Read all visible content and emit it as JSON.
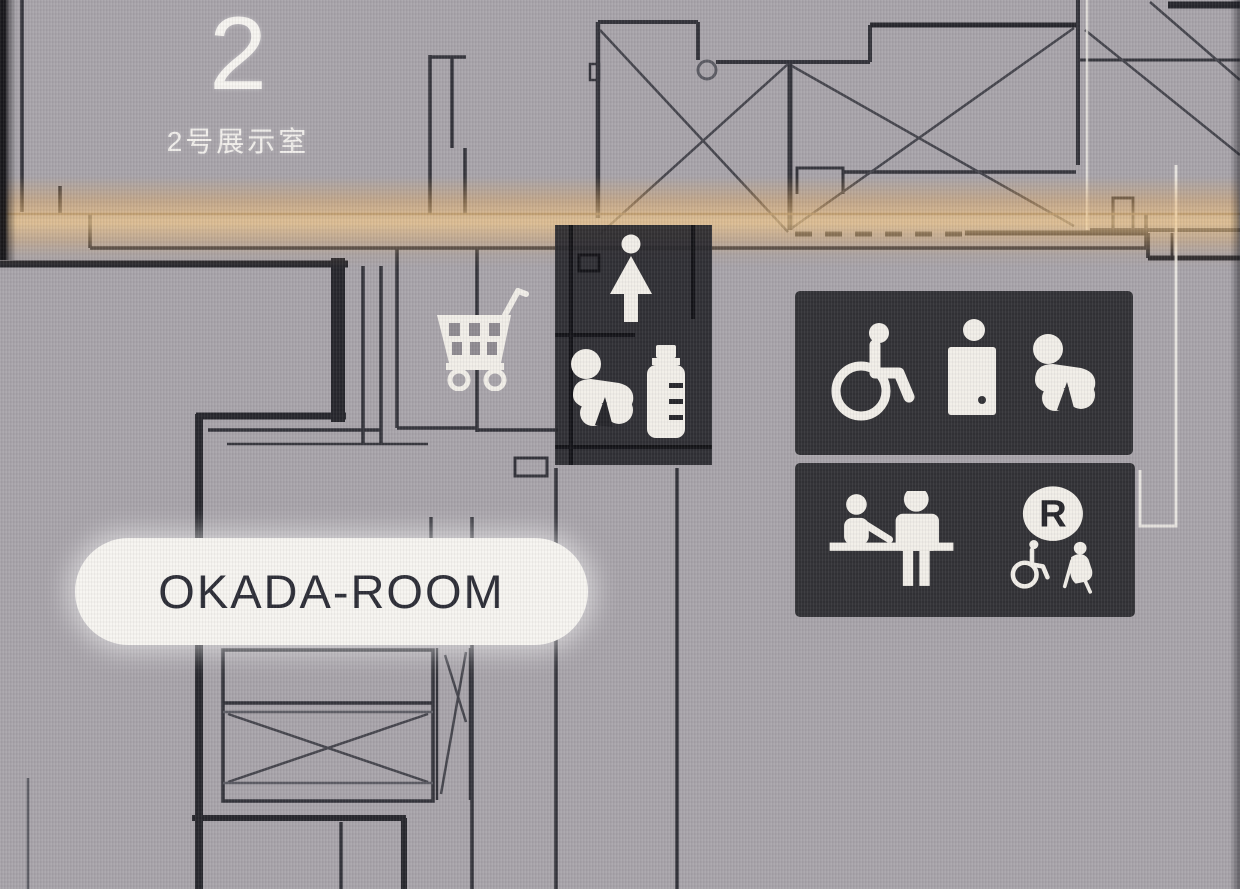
{
  "map": {
    "room2_number": "2",
    "room2_name": "2号展示室",
    "okada_room_label": "OKADA-ROOM",
    "rental_letter": "R",
    "facility_box_icons": [
      "women-restroom",
      "baby-changing",
      "nursing-bottle"
    ],
    "accessible_panel_icons": [
      "wheelchair",
      "ostomate",
      "baby-chair"
    ],
    "services_panel_icons": [
      "reception-desk",
      "wheelchair-rental"
    ],
    "shop_icon": "shopping-cart",
    "colors": {
      "screen_background": "#a8a4aa",
      "panel_background": "#313135",
      "wall_line": "#33333a",
      "glare_band": "#e7b169",
      "label_pill_background": "#f7f5f1",
      "label_text": "#2c2d36",
      "icon_color": "#f2efe9"
    }
  }
}
